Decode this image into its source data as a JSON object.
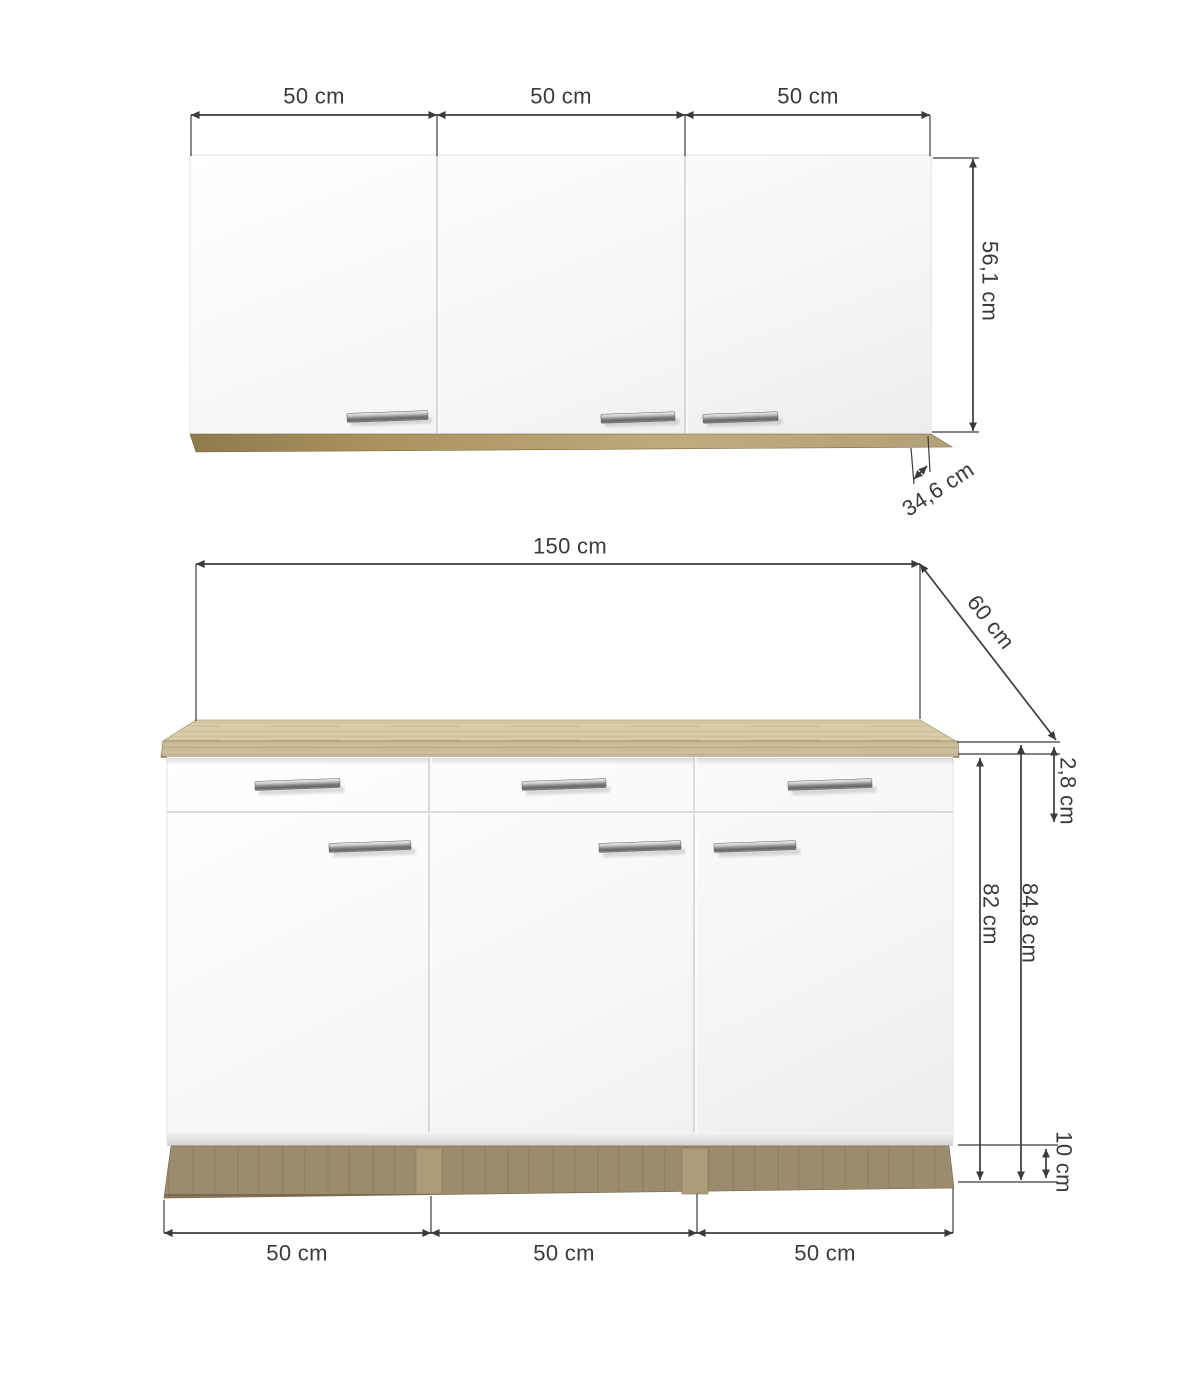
{
  "diagram": {
    "type": "kitchen-cabinet-dimension-drawing",
    "units": "cm",
    "labels": {
      "wall_door1_width": "50 cm",
      "wall_door2_width": "50 cm",
      "wall_door3_width": "50 cm",
      "wall_height": "56,1 cm",
      "wall_depth": "34,6 cm",
      "base_total_width": "150 cm",
      "base_depth": "60 cm",
      "worktop_thickness": "2,8 cm",
      "base_body_height": "82 cm",
      "base_total_height": "84,8 cm",
      "plinth_height": "10 cm",
      "base_door1_width": "50 cm",
      "base_door2_width": "50 cm",
      "base_door3_width": "50 cm"
    },
    "colors": {
      "background": "#ffffff",
      "dimension_line": "#3b3b3b",
      "label_text": "#3a3a3a",
      "cabinet_front": "#f5f5f5",
      "worktop_wood": "#cdbe9b",
      "wall_trim_wood": "#a9935f",
      "plinth_wood": "#9c8c6e",
      "handle_chrome": "#8f8f8f"
    }
  }
}
